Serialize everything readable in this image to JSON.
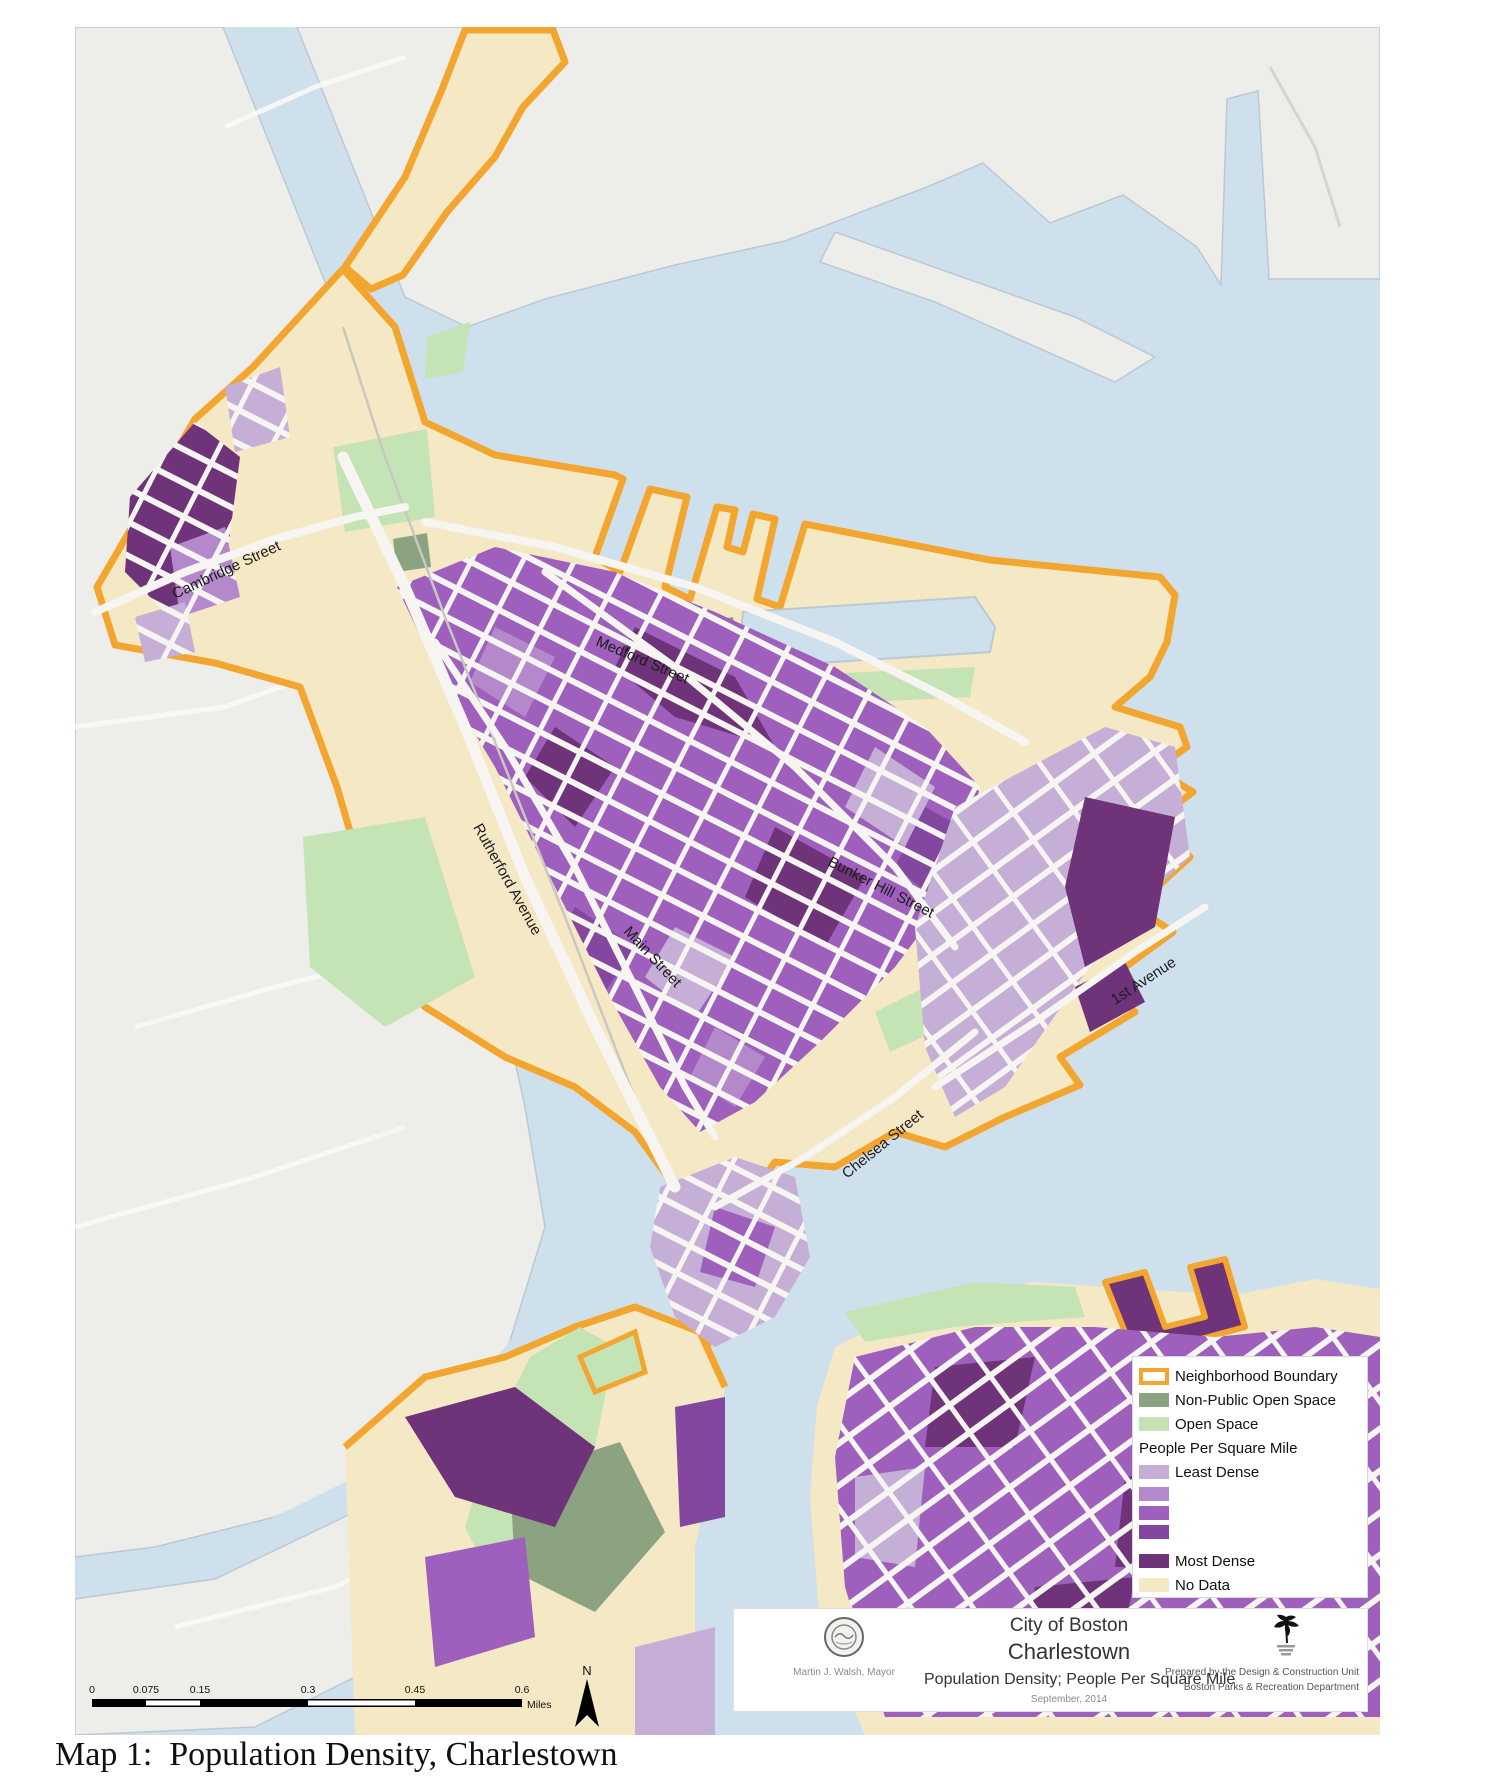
{
  "caption": "Map 1:  Population Density, Charlestown",
  "map": {
    "street_labels": [
      {
        "label": "Cambridge Street"
      },
      {
        "label": "Medford Street"
      },
      {
        "label": "Rutherford Avenue"
      },
      {
        "label": "Main Street"
      },
      {
        "label": "Bunker Hill Street"
      },
      {
        "label": "Chelsea Street"
      },
      {
        "label": "1st Avenue"
      }
    ],
    "north_label": "N",
    "scale_bar": {
      "ticks": [
        "0",
        "0.075",
        "0.15",
        "0.3",
        "0.45",
        "0.6"
      ],
      "unit": "Miles"
    }
  },
  "legend": {
    "items": [
      {
        "label": "Neighborhood Boundary",
        "style": "outline",
        "color": "#F2A52F"
      },
      {
        "label": "Non-Public Open Space",
        "color": "#8BA380"
      },
      {
        "label": "Open Space",
        "color": "#C5E4B6"
      }
    ],
    "density_header": "People Per Square Mile",
    "density_scale": [
      {
        "label": "Least Dense",
        "color": "#C6AFD7"
      },
      {
        "label": "",
        "color": "#B489CC"
      },
      {
        "label": "",
        "color": "#9E60BC"
      },
      {
        "label": "",
        "color": "#8447A0"
      },
      {
        "label": "Most Dense",
        "color": "#6E3379"
      },
      {
        "label": "No Data",
        "color": "#F5E8C4"
      }
    ]
  },
  "title_block": {
    "city": "City of Boston",
    "neighborhood": "Charlestown",
    "subtitle": "Population Density; People Per Square Mile",
    "date": "September, 2014",
    "mayor": "Martin J. Walsh, Mayor",
    "prepared_line1": "Prepared by the Design & Construction Unit",
    "prepared_line2": "Boston Parks & Recreation Department"
  },
  "colors": {
    "boundary_orange": "#F2A52F",
    "water": "#CFE0ED",
    "land_gray": "#EDEDEA",
    "no_data_cream": "#F5E8C4",
    "open_space_green": "#C5E4B6",
    "non_public_green": "#8BA380",
    "density_least": "#C6AFD7",
    "density_2": "#B489CC",
    "density_3": "#9E60BC",
    "density_4": "#8447A0",
    "density_most": "#6E3379"
  }
}
